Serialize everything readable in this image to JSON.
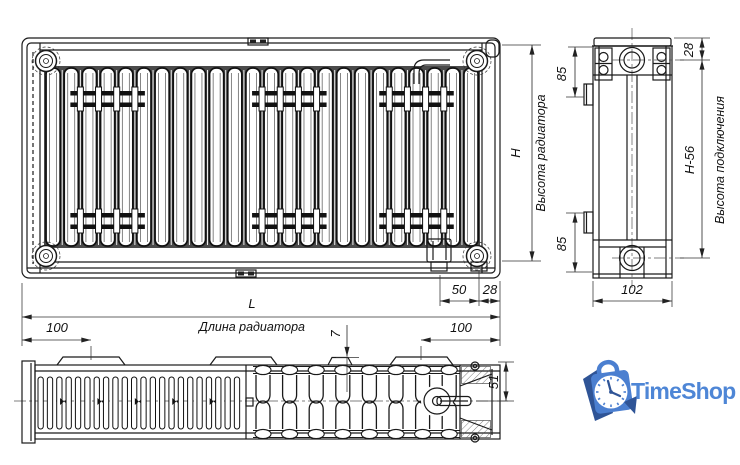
{
  "front_view": {
    "height_symbol": "H",
    "height_caption": "Высота радиатора",
    "length_symbol": "L",
    "length_caption": "Длина радиатора",
    "nipple_spacing": "50",
    "edge_offset": "28"
  },
  "side_view": {
    "top_bracket_offset": "85",
    "cap_offset": "28",
    "connection_spacing": "H-56",
    "connection_caption": "Высота подключения",
    "bottom_bracket_offset": "85",
    "depth": "102"
  },
  "bottom_view": {
    "left_bracket_offset": "100",
    "right_bracket_offset": "100",
    "tab_height": "7",
    "half_depth": "51"
  },
  "logo": {
    "name": "TimeShop",
    "text_color": "#4e86d6",
    "bag_color": "#4b7fd0",
    "dark_color": "#2f5496",
    "ink_color": "#1a1a1a",
    "dim_color": "#333333"
  }
}
